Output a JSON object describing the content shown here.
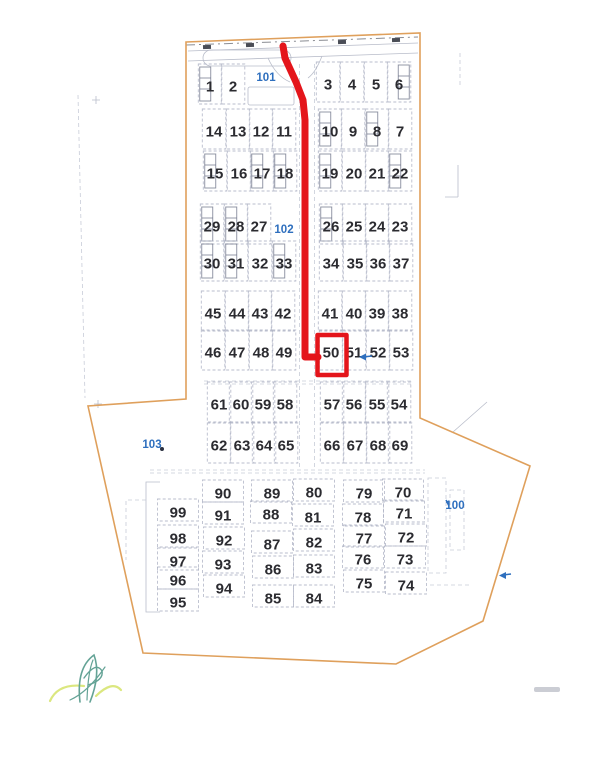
{
  "page": {
    "background": "#ffffff"
  },
  "map_data": {
    "type": "site-plan",
    "description": "Scanned campsite plot map with red route from entrance to highlighted plot 50",
    "highlighted_plot": "50",
    "colors": {
      "route": "#e4151b",
      "boundary": "#dfa05c",
      "plot_number": "#2b2b30",
      "zone_label": "#2e6fbe",
      "grid": "#aeb3c4",
      "logo_teal": "#64a396",
      "logo_yellow": "#dbe77f"
    },
    "boundary_points": "186,42 420,33 420,418 530,466 483,621 396,664 143,653 88,406 186,399",
    "route_points": "283,46 285,58 296,82 303,100 305,120 305,357 318,357",
    "highlight_box": {
      "x": 317.5,
      "y": 335,
      "w": 29,
      "h": 40
    },
    "zone_labels": [
      {
        "label": "101",
        "x": 266,
        "y": 81
      },
      {
        "label": "102",
        "x": 284,
        "y": 233
      },
      {
        "label": "103",
        "x": 152,
        "y": 448
      },
      {
        "label": "100",
        "x": 455,
        "y": 509
      }
    ],
    "cell_sizes": {
      "upper_w": 23.5,
      "upper_h": 40,
      "lower_w": 41,
      "lower_h": 22
    },
    "plots": [
      [
        "1",
        210,
        86,
        "l"
      ],
      [
        "2",
        233,
        86
      ],
      [
        "3",
        328,
        84
      ],
      [
        "4",
        352,
        84
      ],
      [
        "5",
        376,
        84
      ],
      [
        "6",
        399,
        84,
        "r"
      ],
      [
        "7",
        400,
        131
      ],
      [
        "8",
        377,
        131,
        "l"
      ],
      [
        "9",
        353,
        131
      ],
      [
        "10",
        330,
        131,
        "l"
      ],
      [
        "11",
        284,
        131
      ],
      [
        "12",
        261,
        131
      ],
      [
        "13",
        238,
        131
      ],
      [
        "14",
        214,
        131
      ],
      [
        "15",
        215,
        173,
        "l"
      ],
      [
        "16",
        239,
        173
      ],
      [
        "17",
        262,
        173,
        "l"
      ],
      [
        "18",
        285,
        173,
        "l"
      ],
      [
        "19",
        330,
        173,
        "l"
      ],
      [
        "20",
        354,
        173
      ],
      [
        "21",
        377,
        173
      ],
      [
        "22",
        400,
        173,
        "l"
      ],
      [
        "23",
        400,
        226
      ],
      [
        "24",
        377,
        226
      ],
      [
        "25",
        354,
        226
      ],
      [
        "26",
        331,
        226,
        "l"
      ],
      [
        "27",
        259,
        226
      ],
      [
        "28",
        236,
        226,
        "l"
      ],
      [
        "29",
        212,
        226,
        "l"
      ],
      [
        "30",
        212,
        263,
        "l"
      ],
      [
        "31",
        236,
        263,
        "l"
      ],
      [
        "32",
        260,
        263
      ],
      [
        "33",
        284,
        263,
        "l"
      ],
      [
        "34",
        331,
        263
      ],
      [
        "35",
        355,
        263
      ],
      [
        "36",
        378,
        263
      ],
      [
        "37",
        401,
        263
      ],
      [
        "38",
        400,
        313
      ],
      [
        "39",
        377,
        313
      ],
      [
        "40",
        354,
        313
      ],
      [
        "41",
        330,
        313
      ],
      [
        "42",
        283,
        313
      ],
      [
        "43",
        260,
        313
      ],
      [
        "44",
        237,
        313
      ],
      [
        "45",
        213,
        313
      ],
      [
        "46",
        213,
        352
      ],
      [
        "47",
        237,
        352
      ],
      [
        "48",
        261,
        352
      ],
      [
        "49",
        284,
        352
      ],
      [
        "50",
        331,
        352
      ],
      [
        "51",
        354,
        352
      ],
      [
        "52",
        378,
        352
      ],
      [
        "53",
        401,
        352
      ],
      [
        "54",
        399,
        404
      ],
      [
        "55",
        377,
        404
      ],
      [
        "56",
        354,
        404
      ],
      [
        "57",
        332,
        404
      ],
      [
        "58",
        285,
        404
      ],
      [
        "59",
        263,
        404
      ],
      [
        "60",
        241,
        404
      ],
      [
        "61",
        219,
        404
      ],
      [
        "62",
        219,
        445
      ],
      [
        "63",
        242,
        445
      ],
      [
        "64",
        264,
        445
      ],
      [
        "65",
        286,
        445
      ],
      [
        "66",
        332,
        445
      ],
      [
        "67",
        355,
        445
      ],
      [
        "68",
        378,
        445
      ],
      [
        "69",
        400,
        445
      ],
      [
        "70",
        403,
        492
      ],
      [
        "71",
        404,
        513
      ],
      [
        "72",
        406,
        537
      ],
      [
        "73",
        405,
        559
      ],
      [
        "74",
        406,
        585
      ],
      [
        "75",
        364,
        583
      ],
      [
        "76",
        363,
        559
      ],
      [
        "77",
        364,
        538
      ],
      [
        "78",
        363,
        517
      ],
      [
        "79",
        364,
        493
      ],
      [
        "80",
        314,
        492
      ],
      [
        "81",
        313,
        517
      ],
      [
        "82",
        314,
        542
      ],
      [
        "83",
        314,
        568
      ],
      [
        "84",
        314,
        598
      ],
      [
        "85",
        273,
        598
      ],
      [
        "86",
        273,
        569
      ],
      [
        "87",
        272,
        544
      ],
      [
        "88",
        271,
        514
      ],
      [
        "89",
        272,
        493
      ],
      [
        "90",
        223,
        493
      ],
      [
        "91",
        223,
        515
      ],
      [
        "92",
        224,
        540
      ],
      [
        "93",
        223,
        564
      ],
      [
        "94",
        224,
        588
      ],
      [
        "95",
        178,
        602
      ],
      [
        "96",
        178,
        580
      ],
      [
        "97",
        178,
        561
      ],
      [
        "98",
        178,
        538
      ],
      [
        "99",
        178,
        512
      ]
    ]
  }
}
